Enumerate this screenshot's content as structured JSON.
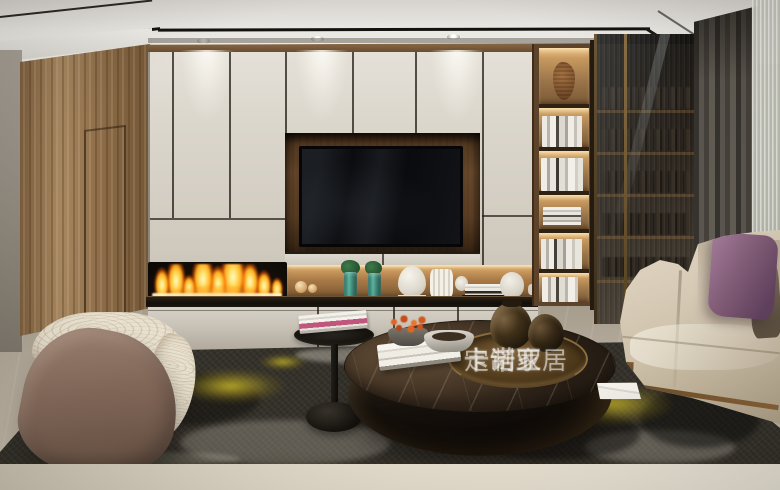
{
  "image": {
    "width": 780,
    "height": 490,
    "description": "Photorealistic rendering of a modern living room: white TV cabinet wall with recessed walnut TV niche, linear fireplace with flames, lit open bookshelf, smoked-glass door cabinet, gray curtains with sheer, cream sofa with purple pillow, curved brown-and-cream armchair, round dark marble coffee table with bronze tray, black pedestal side table, dark abstract rug with yellow accents on light marble floor"
  },
  "watermark": {
    "brand": "卡诺亚",
    "suffix": "定制家居"
  },
  "palette": {
    "ceiling": "#efeee9",
    "cabinet-cream": "#dbd6cc",
    "wood": "#97764f",
    "tv-black": "#0a0b0e",
    "flame-orange": "#ffaf35",
    "flame-yellow": "#ffe27a",
    "counter-black": "#120e09",
    "bronze": "#8a6c3e",
    "glass-dark": "#3a332a",
    "curtain": "#4f4a44",
    "sheer": "#cacbbf",
    "sofa-cream": "#d6cab5",
    "pillow-purple": "#835d78",
    "pillow-taupe": "#837361",
    "chair-brown": "#84695a",
    "chair-cream": "#e9e1d0",
    "rug-dark": "#34312a",
    "rug-yellow": "#cdba2c",
    "floor-marble": "#b3aa9b",
    "table-marble": "#3a2c1f",
    "foreground": "#ded6c5"
  }
}
